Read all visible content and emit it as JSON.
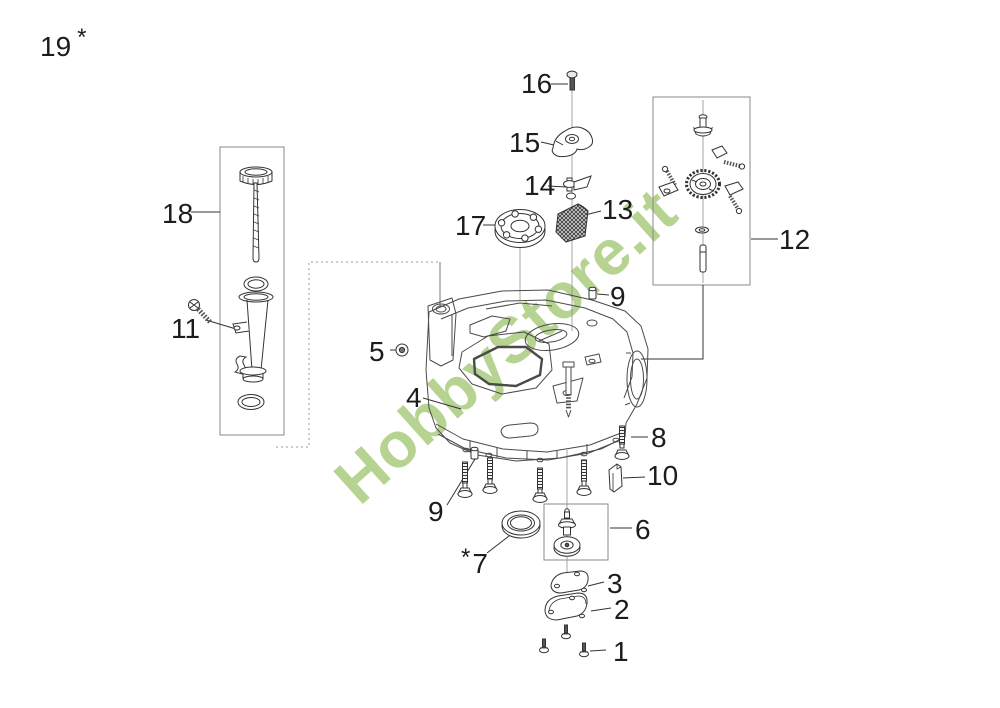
{
  "diagram": {
    "title": "engine-crankcase-exploded-parts-diagram",
    "watermark": {
      "text": "HobbyStore.it",
      "color": "#b7d392"
    },
    "colors": {
      "ink": "#333333",
      "part_line": "#4a4a4a",
      "box_stroke": "#8a8a8a",
      "background": "#ffffff"
    },
    "labels": {
      "n1": "1",
      "n2": "2",
      "n3": "3",
      "n4": "4",
      "n5": "5",
      "n6": "6",
      "n7": "7",
      "n8": "8",
      "n9a": "9",
      "n9b": "9",
      "n10": "10",
      "n11": "11",
      "n12": "12",
      "n13": "13",
      "n14": "14",
      "n15": "15",
      "n16": "16",
      "n17": "17",
      "n18": "18",
      "n19": "19",
      "star7": "*",
      "star19": "*"
    }
  }
}
